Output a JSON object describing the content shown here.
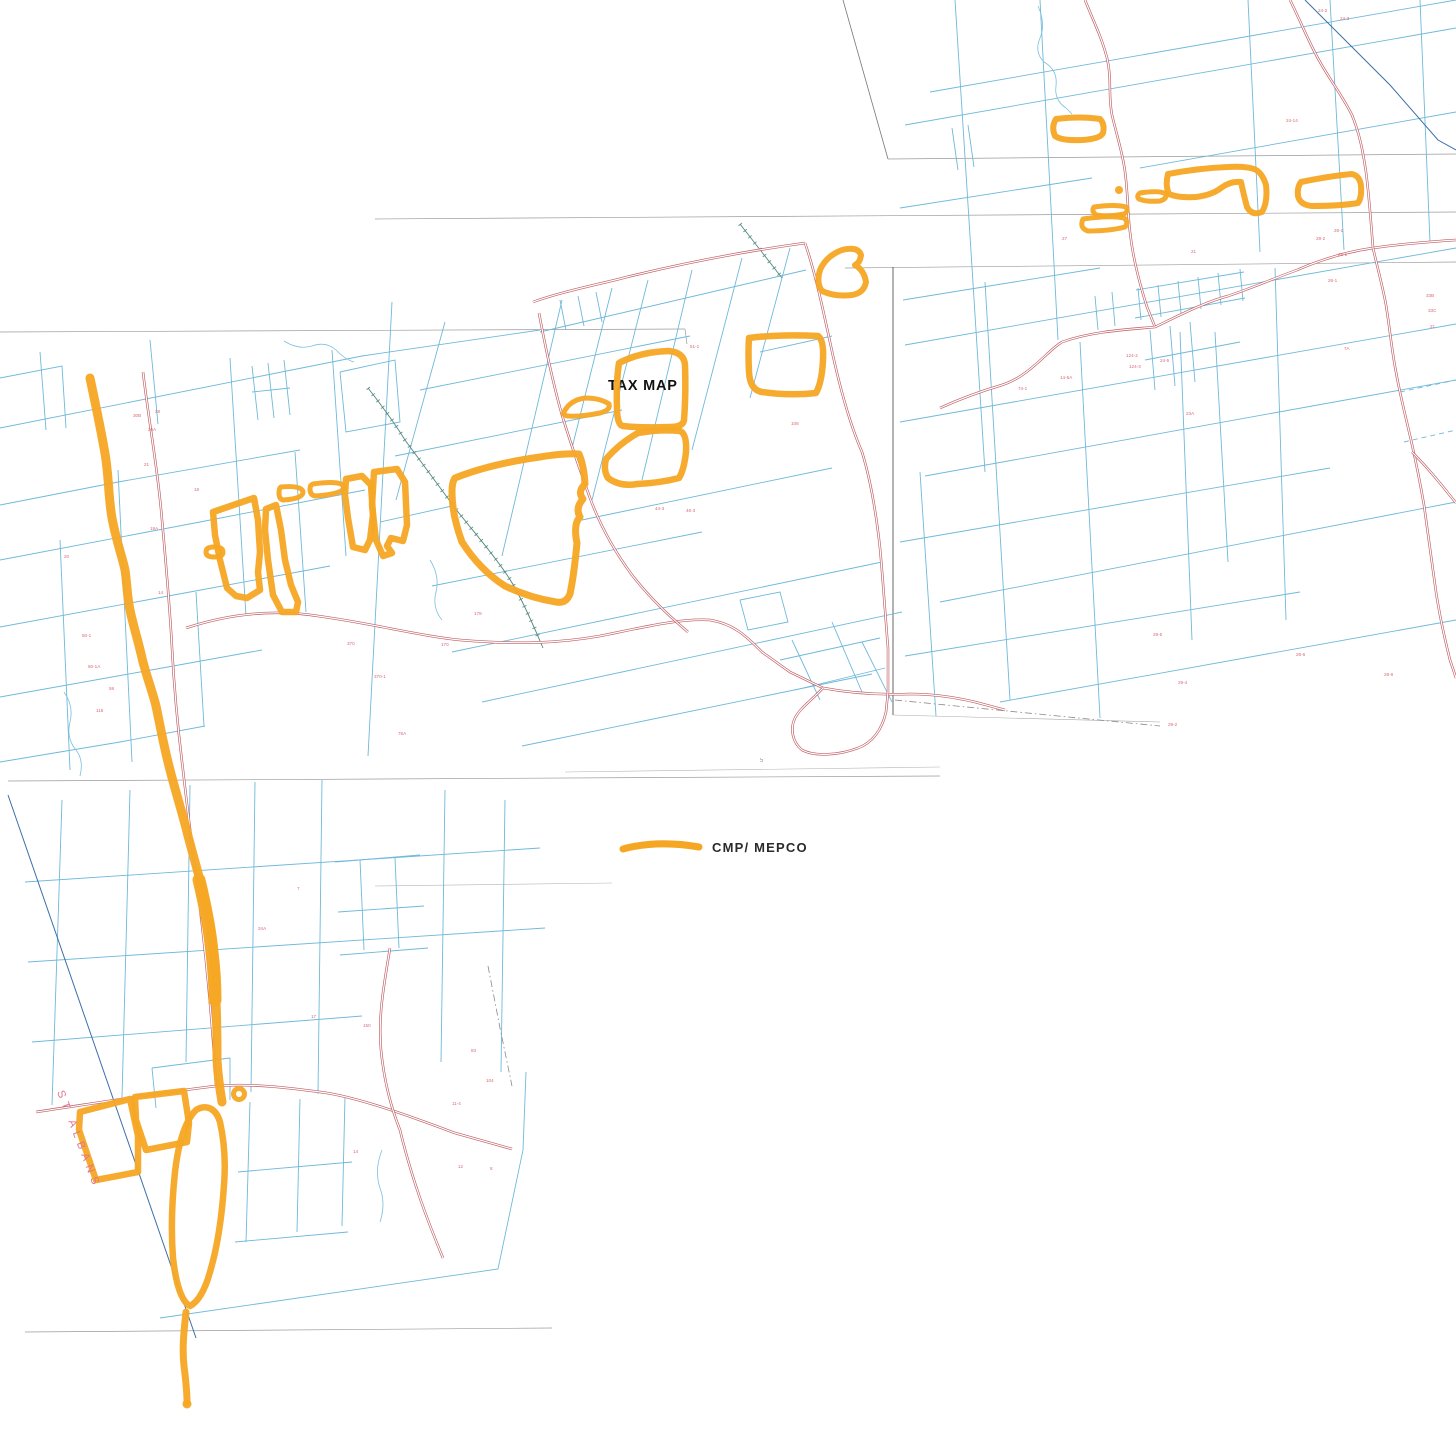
{
  "map": {
    "title_label": "TAX MAP",
    "town_label": "ST ALBANS",
    "legend": {
      "label": "CMP/ MEPCO"
    },
    "colors": {
      "highlight": "#F5A623",
      "parcel": "#6fb9da",
      "road": "#bf5a60",
      "rail": "#4f877e",
      "stream": "#7cc0de",
      "neatline": "#9a9a9a",
      "townline": "#3a6fa8",
      "label": "#d4596a"
    },
    "layers": {
      "neatlines": [
        [
          888,
          159,
          1456,
          154
        ],
        [
          375,
          219,
          1456,
          212
        ],
        [
          845,
          268,
          1456,
          262
        ],
        [
          893,
          267,
          893,
          715,
          "#555555",
          0.9
        ],
        [
          893,
          715,
          1160,
          722,
          "#aaaaaa",
          0.6
        ],
        [
          0,
          332,
          685,
          329
        ],
        [
          685,
          329,
          687,
          344
        ],
        [
          8,
          781,
          940,
          776
        ],
        [
          375,
          886,
          612,
          883,
          "#b5b5b5",
          0.6
        ],
        [
          25,
          1332,
          552,
          1328
        ],
        [
          565,
          772,
          940,
          767,
          "#b5b5b5",
          0.6
        ],
        [
          843,
          0,
          888,
          159,
          "#777777",
          0.8
        ]
      ],
      "parcel_paths": [
        "M0,428 L362,356 L540,330",
        "M0,505 L118,482 L300,450",
        "M0,560 L200,522 L365,490",
        "M0,627 L190,592 L330,566",
        "M0,697 L140,672 L262,650",
        "M0,762 L120,742 L205,726",
        "M0,378 L62,366 L66,428",
        "M40,352 L46,430",
        "M150,340 L158,424",
        "M230,358 L246,616",
        "M332,350 L346,556",
        "M118,470 L132,762",
        "M60,540 L70,770",
        "M295,452 L306,612",
        "M196,592 L204,726",
        "M340,372 L395,360 L400,422 L346,432 L340,372",
        "M252,366 L258,420 M268,363 L274,418 M284,360 L290,415 M252,392 L290,388",
        "M62,800 L52,1105",
        "M130,790 L122,1098",
        "M190,785 L186,1062",
        "M255,782 L251,1092",
        "M322,780 L318,1094",
        "M445,790 L441,1062",
        "M505,800 L501,1072",
        "M25,882 L540,848",
        "M28,962 L545,928",
        "M32,1042 L362,1016",
        "M250,1102 L246,1242 M300,1099 L297,1232 M345,1096 L342,1226 M238,1172 L352,1162 M235,1242 L348,1232",
        "M160,1318 L498,1269 L523,1150 L526,1072",
        "M335,862 L420,855 M338,912 L424,906 M340,955 L428,948 M360,860 L364,950 M395,858 L399,948",
        "M152,1068 L230,1058 M156,1108 L152,1068 M230,1100 L230,1058",
        "M392,302 L368,756",
        "M420,390 L690,336",
        "M395,456 L622,410",
        "M380,522 L452,506",
        "M582,520 L832,468",
        "M432,586 L702,532",
        "M452,652 L882,562",
        "M482,702 L902,612",
        "M522,746 L872,674",
        "M445,322 L396,500",
        "M562,300 L502,556",
        "M612,288 L572,448",
        "M648,280 L592,500",
        "M692,270 L642,480",
        "M742,258 L692,450",
        "M790,248 L750,398",
        "M540,332 L806,270",
        "M760,352 L832,336",
        "M560,300 L566,330 M578,296 L584,326 M596,292 L602,322",
        "M792,640 L820,700 M832,622 L862,692 M862,642 L892,702 M780,660 L880,638 M795,690 L885,668",
        "M740,600 L780,592 L788,622 L748,630 L740,600",
        "M930,92 L1456,0",
        "M905,125 L1456,28",
        "M900,208 L1092,178",
        "M1140,168 L1456,112",
        "M903,300 L1100,268",
        "M905,345 L1456,248",
        "M900,422 L1456,324",
        "M925,476 L1456,380",
        "M900,542 L1330,468",
        "M940,602 L1456,502",
        "M905,656 L1300,592",
        "M1000,702 L1456,620",
        "M955,0 L985,472",
        "M1040,0 L1058,340",
        "M1248,0 L1260,252",
        "M1330,0 L1344,250",
        "M1420,0 L1430,242",
        "M985,282 L1010,700",
        "M1080,342 L1100,718",
        "M1275,268 L1286,620",
        "M1215,332 L1228,562",
        "M920,472 L936,716",
        "M1180,332 L1192,640",
        "M1138,288 L1141,320 M1158,285 L1161,317 M1178,281 L1181,313 M1198,277 L1201,309 M1218,273 L1221,305 M1240,269 L1243,301 M1135,318 L1245,298 M1136,290 L1244,272",
        "M1150,330 L1155,390 M1170,326 L1175,386 M1190,322 L1195,382 M1145,360 L1240,342",
        "M1095,296 L1098,330 M1112,292 L1115,326",
        "M952,128 L958,170 M968,125 L974,167"
      ],
      "parcel_dashed": [
        "M1400,392 L1456,380",
        "M1404,442 L1456,430"
      ],
      "navy_lines": [
        "M8,795 L196,1338",
        "M1305,0 L1390,85 L1438,140 L1456,150"
      ],
      "streams": [
        "M1038,6 Q1046,24 1040,38 Q1034,52 1044,62 Q1058,70 1056,86 Q1054,100 1066,108 L1072,114",
        "M284,341 Q298,350 312,346 Q326,341 336,350 Q346,360 354,362",
        "M64,692 Q74,706 70,722 Q66,738 76,750 Q84,760 80,776",
        "M382,1150 Q374,1170 380,1188 Q386,1204 380,1222",
        "M430,560 Q440,576 436,592 Q432,608 442,620"
      ],
      "railroads": [
        "M368,388 C382,406 394,422 405,440 C422,463 438,485 455,508 C472,530 490,550 505,572 C518,590 532,622 543,648",
        "M740,224 L782,278"
      ],
      "dashdot": [
        "M488,966 L500,1028 L512,1086",
        "M895,700 L1160,726"
      ],
      "roads": [
        "M143,372 C150,430 158,470 162,520 C167,575 170,610 172,648 C174,686 178,730 183,770 C188,815 194,860 199,900 C204,940 210,1000 213,1040 L216,1086",
        "M36,1112 C90,1104 150,1094 216,1086 C250,1083 290,1088 320,1092 C360,1097 420,1120 455,1133 L512,1149",
        "M390,948 C384,985 378,1015 381,1050 C384,1080 390,1105 400,1130 C412,1180 428,1222 443,1258",
        "M186,628 C235,612 280,610 318,616 C370,623 420,636 460,640 C520,645 560,643 600,636 C640,628 680,618 710,620 C735,624 748,638 762,652 L790,672 L823,688",
        "M823,688 C850,693 880,695 910,694 C935,694 958,698 975,702 L1005,710",
        "M823,688 C812,700 800,708 795,718 C790,728 792,742 802,750 C815,757 840,755 858,748 C872,743 882,730 886,712 L888,692",
        "M539,313 C545,345 552,380 562,415 C572,448 580,470 590,498 C600,525 615,552 632,575 C650,598 668,615 688,632",
        "M533,302 C560,292 600,284 627,277 C680,264 740,252 805,243",
        "M805,243 C815,272 822,305 830,342 C838,380 848,420 862,452 C870,478 876,512 880,548 C883,580 885,612 888,648 L888,692",
        "M1085,0 C1093,20 1102,38 1107,58 C1112,78 1108,95 1112,115 C1118,140 1124,158 1126,180 C1128,200 1128,215 1130,232 C1133,260 1140,285 1147,307 L1155,327",
        "M940,408 C962,398 985,390 1002,385 C1030,376 1048,350 1062,342 C1090,332 1120,330 1155,327 C1180,315 1205,302 1228,296 C1252,288 1275,278 1297,270 C1320,260 1345,252 1373,248 C1400,244 1425,242 1456,240",
        "M1290,0 C1300,20 1310,45 1320,62 C1330,80 1342,95 1352,115 C1360,135 1363,152 1366,172 C1369,195 1371,222 1373,248",
        "M1373,248 C1378,270 1383,288 1386,305 C1390,330 1392,352 1396,372 C1400,395 1406,418 1411,440 C1416,462 1420,482 1424,505 C1428,532 1432,565 1436,592 C1440,618 1445,640 1450,660 L1456,678",
        "M1412,452 C1430,470 1444,488 1456,503"
      ],
      "highlight_paths": [
        {
          "d": "M90,378 C95,402 100,425 104,448 C109,472 108,496 112,518 C116,540 122,556 125,570 C127,583 127,596 130,610 C133,625 138,640 142,658 C146,675 152,690 156,706 C159,720 163,742 168,762 C173,783 180,805 186,828 C191,848 198,872 204,895 C208,912 211,930 213,950 C215,968 216,985 216,1002 C217,1022 217,1042 217,1060 C218,1078 220,1090 222,1102",
          "w": 9
        },
        {
          "d": "M199,880 C205,905 210,930 212,952 C214,968 215,985 215,1000",
          "w": 13
        },
        {
          "d": "M186,1312 C184,1330 182,1348 184,1366 C186,1382 187,1392 187,1402",
          "w": 7
        },
        {
          "d": "M196,1110 C206,1104 216,1108 220,1122 C224,1140 226,1160 224,1185 C222,1215 218,1245 210,1272 C205,1290 198,1302 190,1306 C182,1302 176,1285 173,1258 C171,1232 172,1200 175,1172 C178,1146 184,1122 196,1110 Z",
          "w": 6.5
        },
        {
          "d": "M80,1112 L130,1099 L138,1136 L138,1172 L96,1180 L79,1130 Z",
          "w": 6.5
        },
        {
          "d": "M135,1097 L184,1091 L189,1123 L187,1142 L146,1150 L136,1120 Z",
          "w": 6.5
        },
        {
          "d": "M206,552 Q206,547 214,547 Q223,547 223,552 Q223,557 214,557 Q206,557 206,552 Z",
          "w": 5
        },
        {
          "d": "M213,512 L254,498 L258,520 L260,552 L258,572 L260,590 L247,598 L236,596 L227,588 L220,560 L215,535 Z",
          "w": 6.5
        },
        {
          "d": "M266,509 L276,505 L281,530 L285,560 L291,585 L298,602 L296,612 L282,612 L273,595 L268,560 L265,530 Z",
          "w": 6.5
        },
        {
          "d": "M281,487 Q302,485 303,492 Q303,499 283,500 Q279,499 279,493 Q279,488 281,487 Z",
          "w": 5
        },
        {
          "d": "M313,484 Q342,480 344,487 Q344,494 315,496 Q310,495 310,489 Q310,485 313,484 Z",
          "w": 5
        },
        {
          "d": "M346,479 L362,476 L371,485 L373,515 L370,540 L365,550 L353,547 L348,518 L345,495 Z",
          "w": 6.5
        },
        {
          "d": "M374,472 L397,469 L405,482 L407,525 L403,541 L391,538 L387,546 L392,553 L383,556 L376,540 L372,505 Z",
          "w": 6.5
        },
        {
          "d": "M564,412 Q570,400 585,398 Q600,398 609,404 Q611,410 600,413 Q580,417 568,416 Q562,415 564,412 Z",
          "w": 5
        },
        {
          "d": "M619,363 Q640,352 668,351 Q684,352 685,365 Q686,395 684,420 Q683,427 670,427 Q640,428 623,426 Q617,425 617,408 Q616,382 619,363 Z",
          "w": 6.5
        },
        {
          "d": "M606,459 Q620,443 638,433 Q660,429 680,431 Q687,434 686,452 Q684,470 679,478 Q660,483 637,484 Q620,487 608,478 Q603,470 606,459 Z",
          "w": 6.5
        },
        {
          "d": "M749,338 Q780,334 818,336 Q824,340 823,360 Q822,382 816,393 Q790,396 762,392 Q750,390 749,372 Q748,352 749,338 Z",
          "w": 6.5
        },
        {
          "d": "M842,250 Q858,246 861,255 Q860,263 855,265 Q864,270 866,282 Q864,293 852,295 Q835,297 822,291 Q816,283 820,270 Q826,256 842,250 Z",
          "w": 6
        },
        {
          "d": "M455,478 Q490,464 540,457 Q565,453 579,454 Q584,466 585,484 Q577,492 583,499 Q575,508 580,517 Q573,524 577,543 Q574,575 570,594 Q566,604 556,602 Q530,598 505,586 Q480,570 462,542 Q452,515 452,492 Q452,482 455,478 Z",
          "w": 7
        },
        {
          "d": "M1056,119 Q1080,116 1100,119 Q1105,124 1103,133 Q1100,139 1082,140 Q1062,141 1055,136 Q1051,127 1056,119 Z",
          "w": 6
        },
        {
          "d": "M1168,174 Q1200,168 1228,167 Q1245,166 1254,169 Q1262,172 1266,185 Q1268,202 1262,212 Q1252,216 1247,207 Q1244,196 1241,182 Q1230,181 1221,188 Q1212,195 1196,197 Q1178,198 1169,194 Q1165,185 1168,174 Z",
          "w": 6
        },
        {
          "d": "M1140,193 Q1160,190 1166,194 Q1167,199 1160,201 Q1146,202 1139,199 Q1136,196 1140,193 Z",
          "w": 5
        },
        {
          "d": "M1094,207 Q1115,204 1126,207 Q1129,211 1124,214 Q1108,217 1096,215 Q1091,211 1094,207 Z",
          "w": 5
        },
        {
          "d": "M1083,219 Q1110,215 1124,218 Q1129,222 1125,227 Q1110,231 1088,231 Q1079,228 1083,219 Z",
          "w": 5
        },
        {
          "d": "M1301,182 Q1330,176 1352,174 Q1360,176 1361,186 Q1362,197 1358,203 Q1340,206 1312,206 Q1300,205 1298,196 Q1297,187 1301,182 Z",
          "w": 6
        }
      ],
      "highlight_rings": [
        {
          "cx": 239,
          "cy": 1094,
          "r": 5.5,
          "w": 5
        }
      ],
      "highlight_dots": [
        {
          "cx": 1119,
          "cy": 190,
          "r": 4
        },
        {
          "cx": 187,
          "cy": 1404,
          "r": 4.5
        }
      ],
      "labels": [
        [
          "30B",
          133,
          417
        ],
        [
          "28",
          155,
          413
        ],
        [
          "26A",
          148,
          431
        ],
        [
          "21",
          144,
          466
        ],
        [
          "19A",
          150,
          530
        ],
        [
          "20",
          64,
          558
        ],
        [
          "18",
          194,
          491
        ],
        [
          "14",
          158,
          594
        ],
        [
          "50-1",
          82,
          637
        ],
        [
          "50-1A",
          88,
          668
        ],
        [
          "58",
          109,
          690
        ],
        [
          "118",
          96,
          712
        ],
        [
          "17",
          311,
          1018
        ],
        [
          "150",
          363,
          1027
        ],
        [
          "83",
          471,
          1052
        ],
        [
          "104",
          486,
          1082
        ],
        [
          "11-4",
          452,
          1105
        ],
        [
          "14",
          353,
          1153
        ],
        [
          "8",
          490,
          1170
        ],
        [
          "12",
          458,
          1168
        ],
        [
          "370",
          347,
          645
        ],
        [
          "370-1",
          374,
          678
        ],
        [
          "34A",
          258,
          930
        ],
        [
          "7",
          297,
          890
        ],
        [
          "51-1",
          690,
          348
        ],
        [
          "46-3",
          686,
          512
        ],
        [
          "44-3",
          655,
          510
        ],
        [
          "178",
          474,
          615
        ],
        [
          "170",
          441,
          646
        ],
        [
          "76A",
          398,
          735
        ],
        [
          "108",
          791,
          425
        ],
        [
          "14-5A",
          1060,
          379
        ],
        [
          "74-1",
          1018,
          390
        ],
        [
          "124-2",
          1126,
          357
        ],
        [
          "124-3",
          1129,
          368
        ],
        [
          "24-5",
          1160,
          362
        ],
        [
          "24-14",
          1286,
          122
        ],
        [
          "28-1",
          1334,
          232
        ],
        [
          "29-1",
          1338,
          256
        ],
        [
          "26-1",
          1328,
          282
        ],
        [
          "21",
          1191,
          253
        ],
        [
          "24-2",
          1318,
          12
        ],
        [
          "24-3",
          1340,
          20
        ],
        [
          "28-2",
          1316,
          240
        ],
        [
          "7A",
          1344,
          350
        ],
        [
          "33B",
          1426,
          297
        ],
        [
          "33C",
          1428,
          312
        ],
        [
          "21",
          1430,
          328
        ],
        [
          "29-5",
          1153,
          636
        ],
        [
          "29-4",
          1178,
          684
        ],
        [
          "29-2",
          1168,
          726
        ],
        [
          "28-6",
          1296,
          656
        ],
        [
          "28-8",
          1384,
          676
        ],
        [
          "23A",
          1186,
          415
        ],
        [
          "27",
          1062,
          240
        ],
        [
          "5",
          760,
          762,
          "#8a8a8a",
          6
        ]
      ]
    }
  }
}
